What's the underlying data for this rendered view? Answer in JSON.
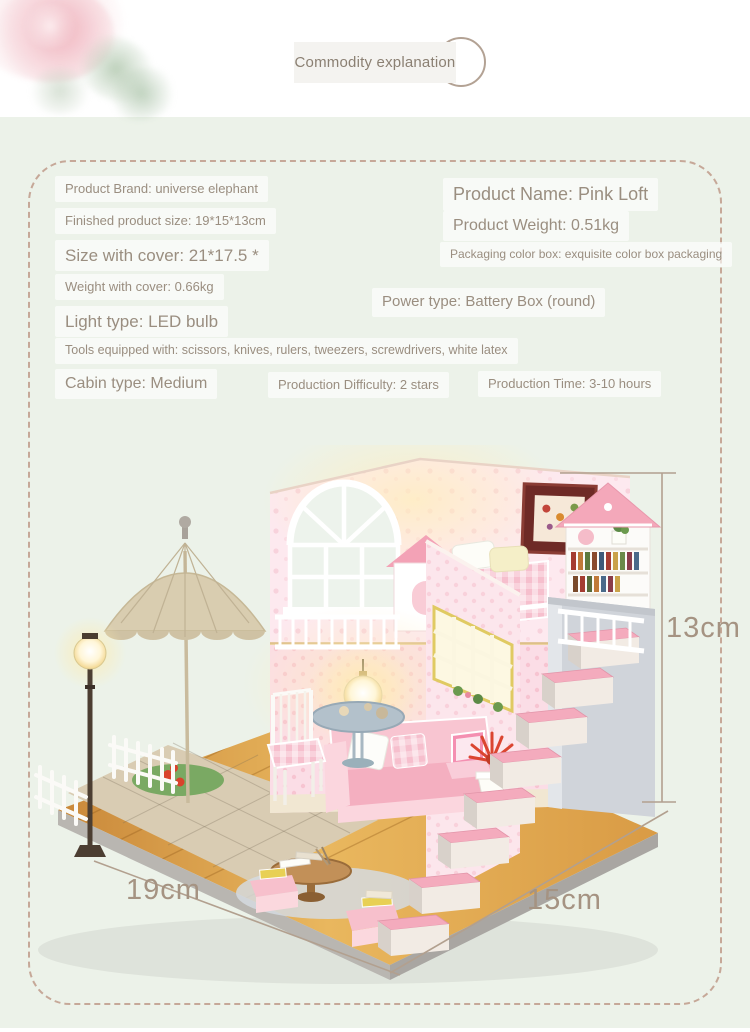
{
  "header": {
    "tab_label": "Commodity explanation"
  },
  "specs": {
    "brand": "Product Brand: universe elephant",
    "finished_size": "Finished product size: 19*15*13cm",
    "size_with_cover": "Size with cover: 21*17.5 *",
    "weight_with_cover": "Weight with cover: 0.66kg",
    "light_type": "Light type: LED bulb",
    "tools": "Tools equipped with: scissors, knives, rulers, tweezers, screwdrivers, white latex",
    "product_name": "Product Name: Pink Loft",
    "product_weight": "Product Weight: 0.51kg",
    "packaging": "Packaging color box: exquisite color box packaging",
    "power_type": "Power type: Battery Box (round)",
    "cabin_type": "Cabin type: Medium",
    "difficulty": "Production Difficulty: 2 stars",
    "production_time": "Production Time: 3-10 hours"
  },
  "product_photo": {
    "description": "DIY miniature pink loft dollhouse with LED lighting, staircase, umbrella patio",
    "dimension_height": "13cm",
    "dimension_depth": "19cm",
    "dimension_width": "15cm"
  },
  "colors": {
    "mint_background": "#ecf2e9",
    "dashed_border": "#c6a898",
    "text": "#9a8e80",
    "accent_pink": "#f4abbd",
    "wood": "#e0a64e"
  }
}
